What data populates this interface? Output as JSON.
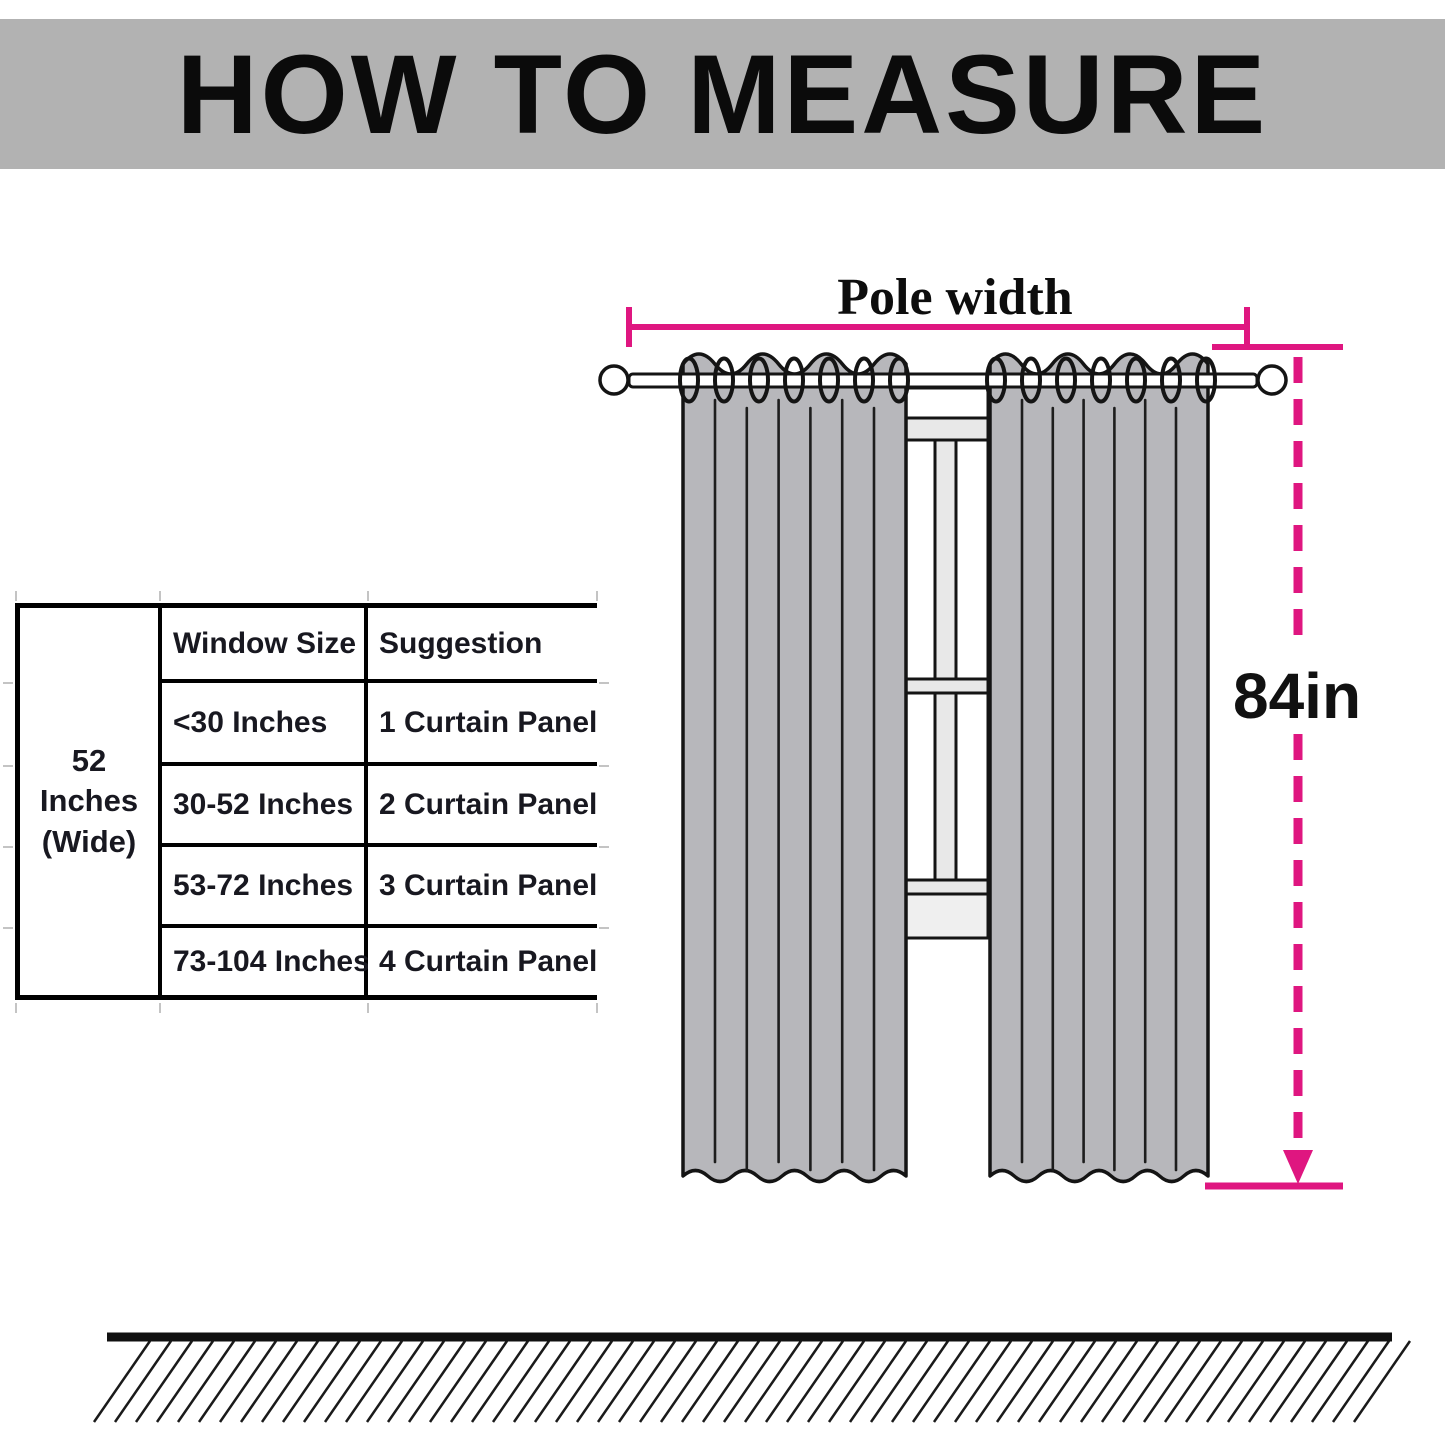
{
  "title": "HOW TO MEASURE",
  "colors": {
    "accent": "#df1680",
    "banner_bg": "#b2b2b2",
    "curtain_fill": "#b7b7bb",
    "window_frame_light": "#e8e8e8",
    "outline_ink": "#141414"
  },
  "table": {
    "side_label": {
      "line1": "52 Inches",
      "line2": "(Wide)"
    },
    "columns": {
      "window_size": "Window Size",
      "suggestion": "Suggestion"
    },
    "rows": [
      {
        "window_size": "<30 Inches",
        "suggestion": "1 Curtain Panel"
      },
      {
        "window_size": "30-52 Inches",
        "suggestion": "2 Curtain Panel"
      },
      {
        "window_size": "53-72 Inches",
        "suggestion": "3 Curtain Panel"
      },
      {
        "window_size": "73-104 Inches",
        "suggestion": "4 Curtain Panel"
      }
    ]
  },
  "diagram": {
    "pole_width_label": "Pole width",
    "height_label": "84in"
  }
}
